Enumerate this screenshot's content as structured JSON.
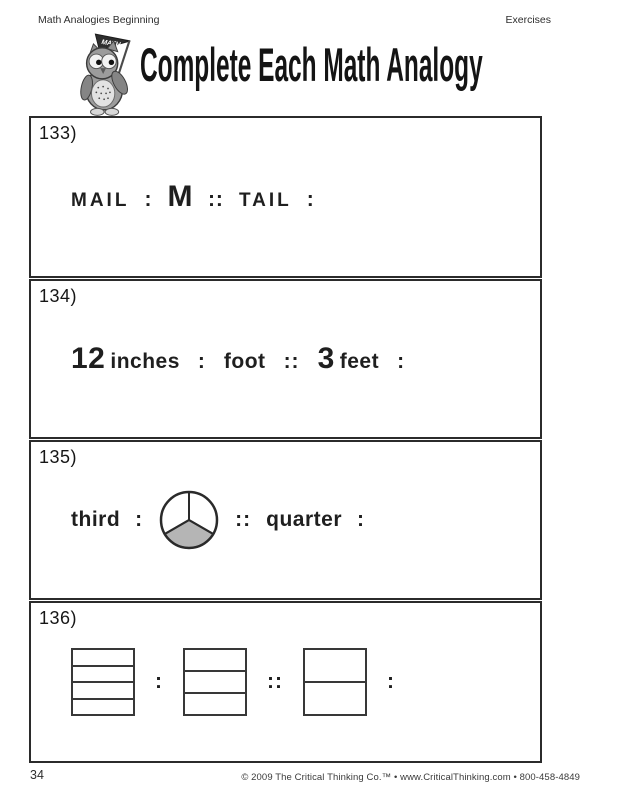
{
  "header": {
    "left": "Math Analogies Beginning",
    "right": "Exercises"
  },
  "title": {
    "text": "Complete Each Math Analogy",
    "mascot": "owl holding MATH pennant flag",
    "flag_label": "MATH"
  },
  "exercises": [
    {
      "number": "133)",
      "terms": {
        "a": "MAIL",
        "colon1": ":",
        "b": "M",
        "double_colon": "::",
        "c": "TAIL",
        "colon2": ":"
      }
    },
    {
      "number": "134)",
      "terms": {
        "a_num": "12",
        "a_unit": "inches",
        "colon1": ":",
        "b": "foot",
        "double_colon": "::",
        "c_num": "3",
        "c_unit": "feet",
        "colon2": ":"
      }
    },
    {
      "number": "135)",
      "terms": {
        "a": "third",
        "colon1": ":",
        "double_colon": "::",
        "c": "quarter",
        "colon2": ":"
      },
      "pie": {
        "divisions": 3,
        "shaded_sectors": 1,
        "shaded_position": "bottom",
        "shaded_color": "#b5b5b5"
      }
    },
    {
      "number": "136)",
      "terms": {
        "colon1": ":",
        "double_colon": "::",
        "colon2": ":"
      },
      "shapes": [
        {
          "kind": "divided-rectangle",
          "divisions": 4
        },
        {
          "kind": "divided-rectangle",
          "divisions": 3
        },
        {
          "kind": "divided-rectangle",
          "divisions": 2
        }
      ]
    }
  ],
  "footer": {
    "page_number": "34",
    "copyright": "© 2009 The Critical Thinking Co.™ • www.CriticalThinking.com • 800-458-4849"
  }
}
